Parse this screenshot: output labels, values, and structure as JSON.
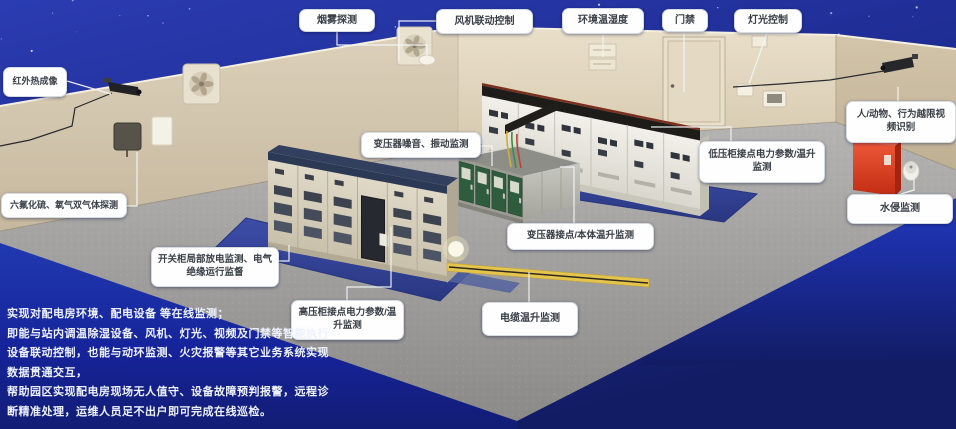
{
  "callouts": [
    {
      "id": "smoke-detection",
      "label": "烟雾探测"
    },
    {
      "id": "fan-linkage-control",
      "label": "风机联动控制"
    },
    {
      "id": "env-temp-humidity",
      "label": "环境温湿度"
    },
    {
      "id": "door-access",
      "label": "门禁"
    },
    {
      "id": "light-control",
      "label": "灯光控制"
    },
    {
      "id": "infrared-thermal-imaging",
      "label": "红外热成像"
    },
    {
      "id": "sf6-o2-gas-detection",
      "label": "六氟化硫、氧气双气体探测"
    },
    {
      "id": "human-animal-video-recognition",
      "label": "人/动物、行为越限视频识别"
    },
    {
      "id": "water-intrusion-monitoring",
      "label": "水侵监测"
    },
    {
      "id": "transformer-noise-vibration",
      "label": "变压器噪音、振动监测"
    },
    {
      "id": "lv-cabinet-power-temp",
      "label": "低压柜接点电力参数/温升监测"
    },
    {
      "id": "transformer-contact-body-temp",
      "label": "变压器接点/本体温升监测"
    },
    {
      "id": "switchgear-partial-discharge",
      "label": "开关柜局部放电监测、电气绝缘运行监督"
    },
    {
      "id": "hv-cabinet-power-temp",
      "label": "高压柜接点电力参数/温升监测"
    },
    {
      "id": "cable-temp-rise",
      "label": "电缆温升监测"
    }
  ],
  "description": {
    "lines": [
      "实现对配电房环境、配电设备 等在线监测；",
      "即能与站内调温除湿设备、风机、灯光、视频及门禁等智能执行",
      "设备联动控制，也能与动环监测、火灾报警等其它业务系统实现",
      "数据贯通交互，",
      "帮助园区实现配电房现场无人值守、设备故障预判报警，远程诊",
      "断精准处理，运维人员足不出户即可完成在线巡检。"
    ]
  },
  "colors": {
    "sky_blue": "#1d2b90",
    "panel_blue": "#1d3cc0",
    "floor_gray": "#a3a2a0",
    "wall_beige": "#d9cdb6",
    "mat_blue": "#32418f",
    "cabinet_green": "#2f5f3e",
    "alert_red": "#d83a20",
    "label_bg": "#fefefe",
    "label_text": "#3a4048"
  }
}
